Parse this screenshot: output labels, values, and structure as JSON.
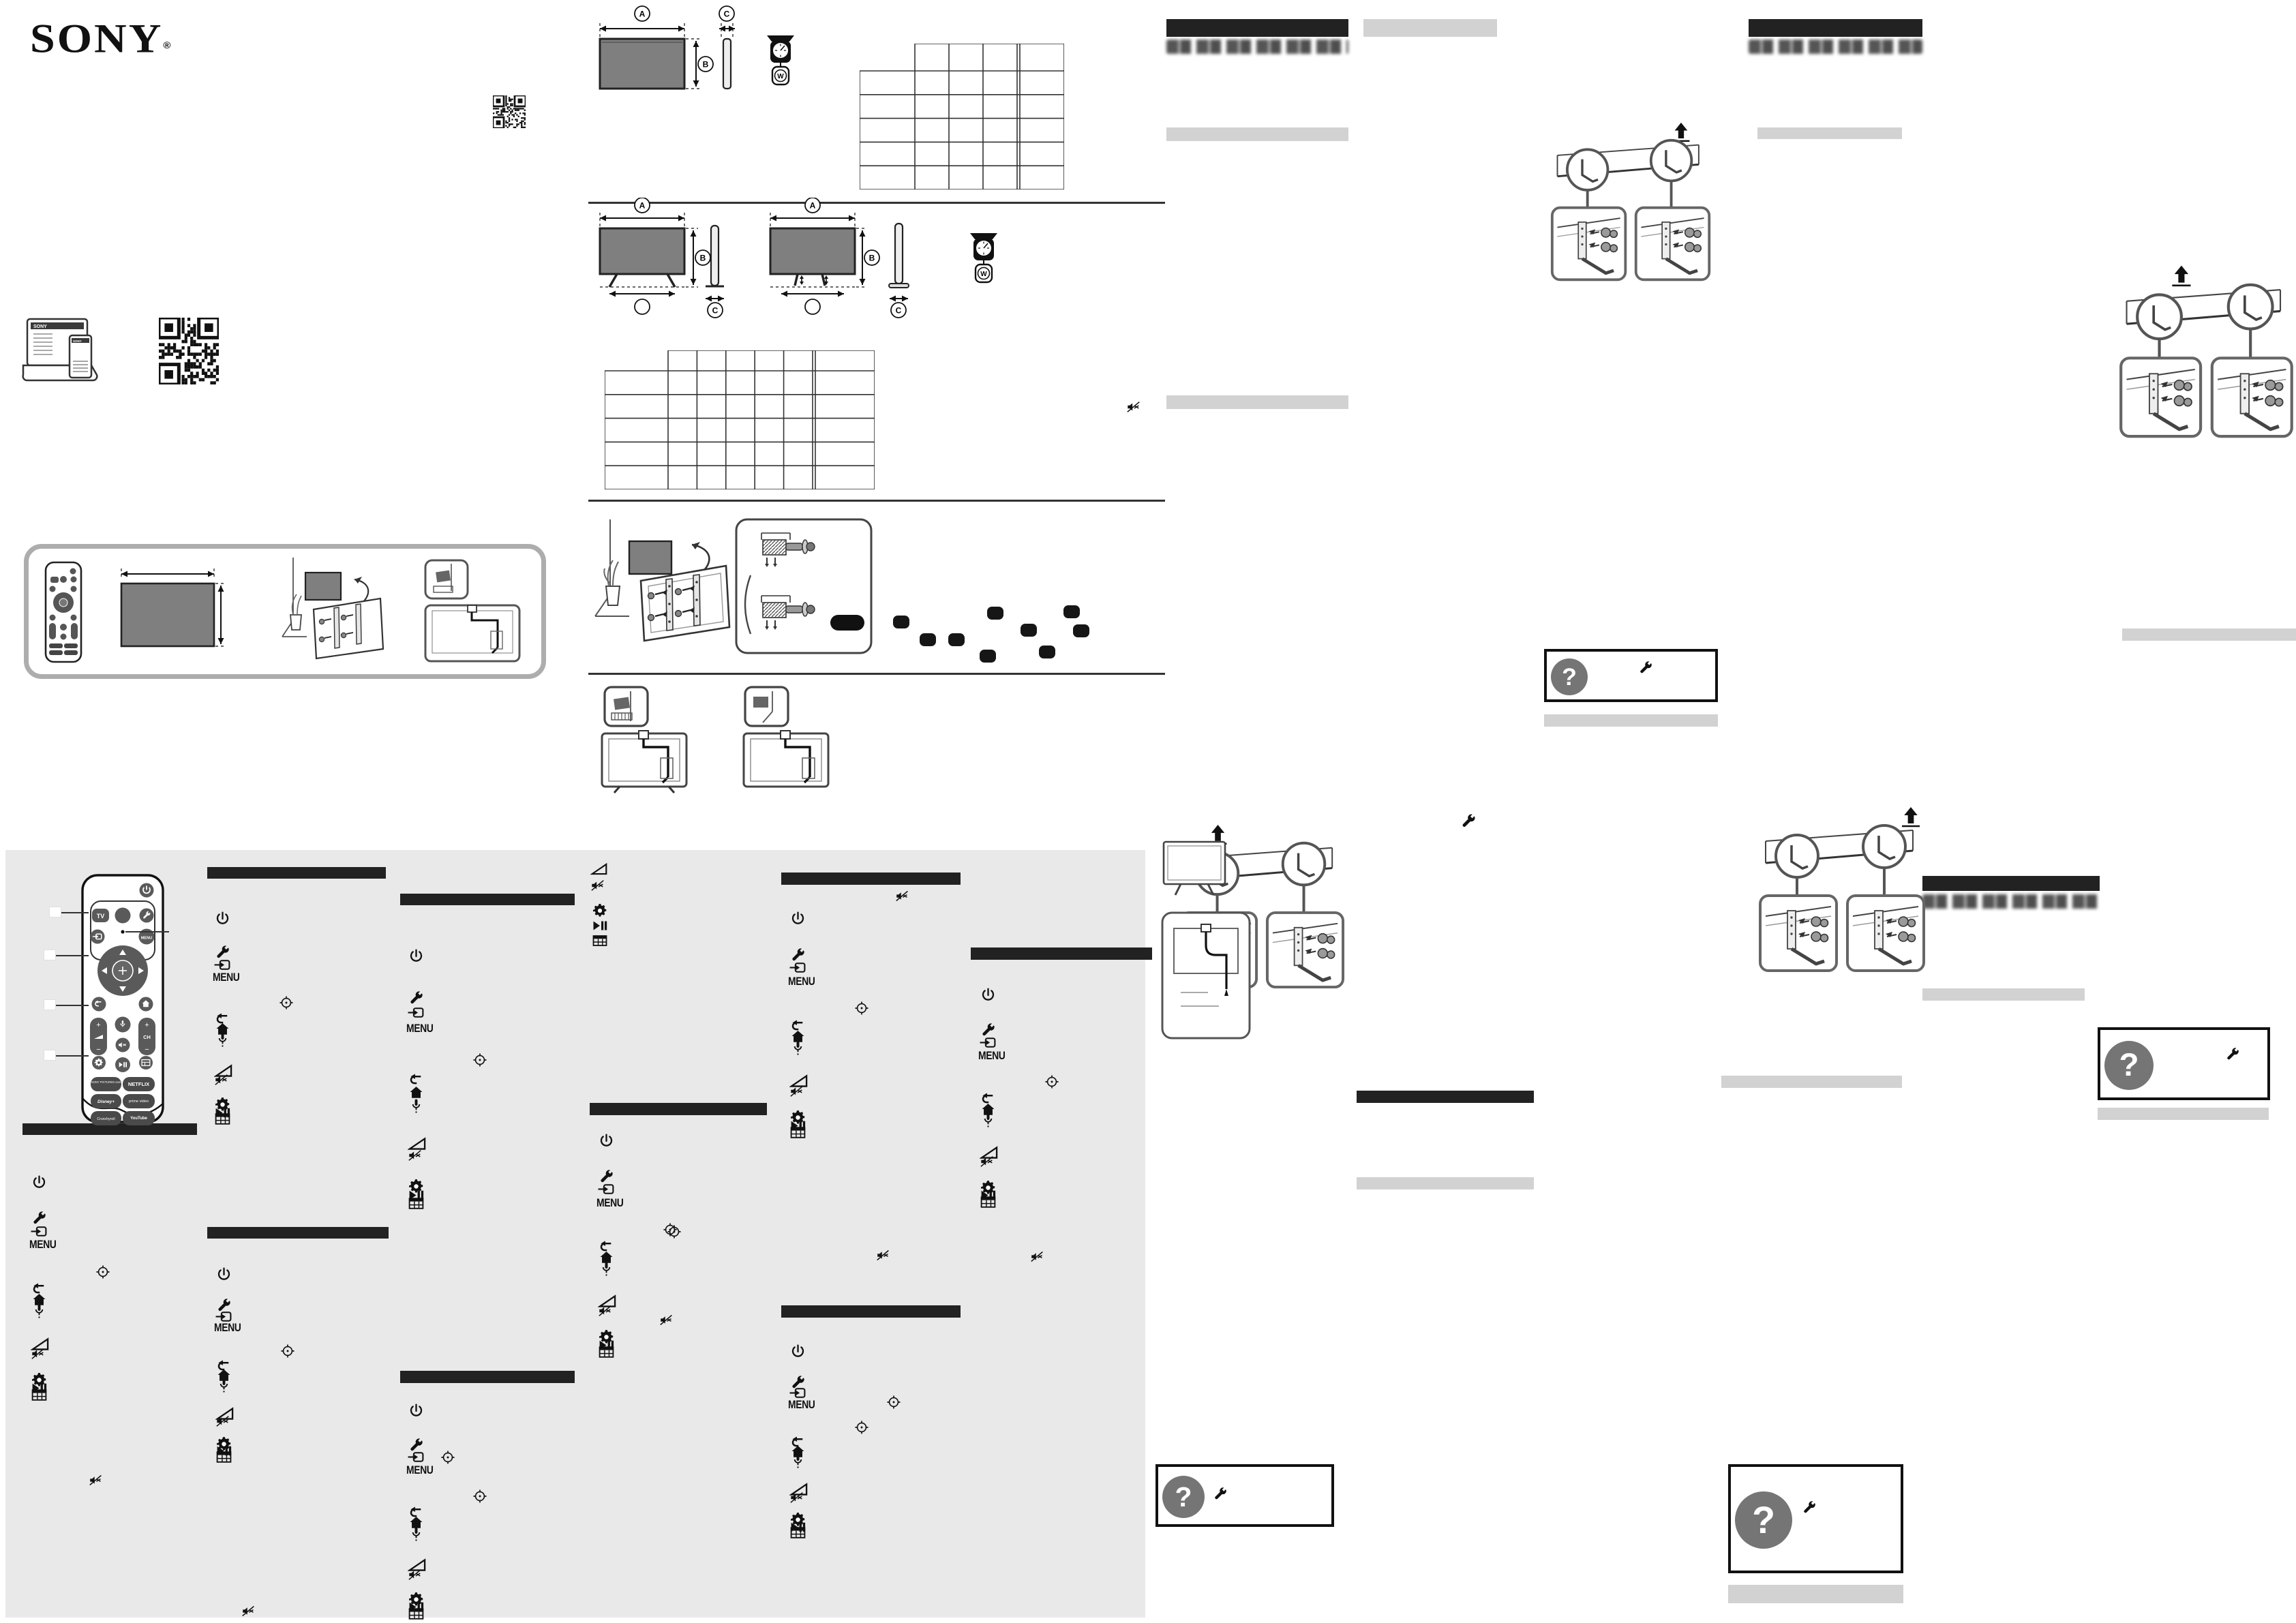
{
  "page_colors": {
    "background": "#ffffff",
    "panel_background": "#e9e9e9",
    "section_bar_black": "#222222",
    "subsection_bar_gray": "#d2d2d2",
    "help_circle_gray": "#757575",
    "tv_screen_gray": "#7f7f7f"
  },
  "brand": {
    "logo": "SONY",
    "registered_mark": "®"
  },
  "labels": {
    "menu": "MENU",
    "question_mark": "?",
    "channel": "CH",
    "tv_button": "TV",
    "plus": "+",
    "minus": "−",
    "dimensions": {
      "width": "A",
      "height": "B",
      "depth": "C",
      "stand_width": "D",
      "weight": "W"
    }
  },
  "remote_services": [
    "SONY PICTURES core",
    "NETFLIX",
    "Disney+",
    "prime video",
    "Crunchyroll",
    "YouTube"
  ],
  "icon_legend_order": [
    "power",
    "wrench",
    "input",
    "menu",
    "select",
    "back",
    "home",
    "mic",
    "volume",
    "mute",
    "settings",
    "play-pause",
    "guide"
  ],
  "spec_tables": [
    {
      "name": "dimensions-table-without-stand",
      "header_columns": 4,
      "data_columns": 5,
      "body_rows": 5,
      "cells_empty": true
    },
    {
      "name": "dimensions-table-with-stand",
      "header_columns": 6,
      "data_columns": 7,
      "body_rows": 5,
      "cells_empty": true
    }
  ],
  "qr_codes": [
    {
      "name": "qr-top"
    },
    {
      "name": "qr-support-site"
    }
  ]
}
